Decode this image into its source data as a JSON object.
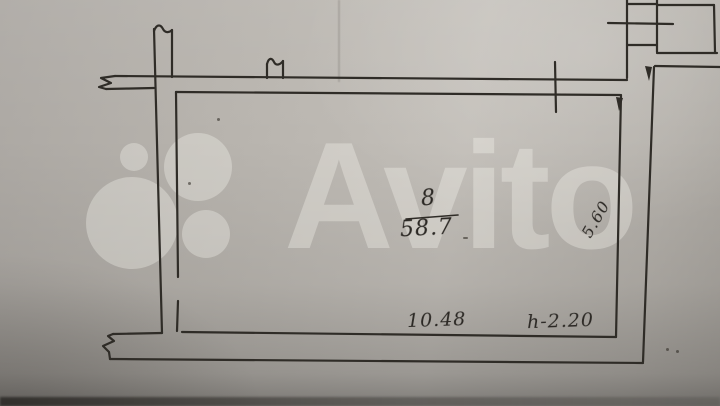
{
  "watermark": {
    "text": "Avito",
    "color": "#fffef7",
    "opacity": "0.30",
    "logo_circles": [
      {
        "name": "small-top-left",
        "cx": 134,
        "cy": 157,
        "r": 14
      },
      {
        "name": "large-top-right",
        "cx": 198,
        "cy": 167,
        "r": 34
      },
      {
        "name": "large-bottom-left",
        "cx": 132,
        "cy": 223,
        "r": 46
      },
      {
        "name": "medium-bottom-right",
        "cx": 206,
        "cy": 234,
        "r": 24
      }
    ]
  },
  "plan_labels": {
    "room_number": "8",
    "room_area": "58.7",
    "width_dimension": "10.48",
    "ceiling_height": "h-2.20",
    "side_dimension": "5.60"
  },
  "palette": {
    "paper_mid": "#b7b3ad",
    "paper_light": "#c2beb8",
    "paper_dark": "#8f8c86",
    "ink": "#2f2c27",
    "handwriting_ink": "#2b2824"
  }
}
